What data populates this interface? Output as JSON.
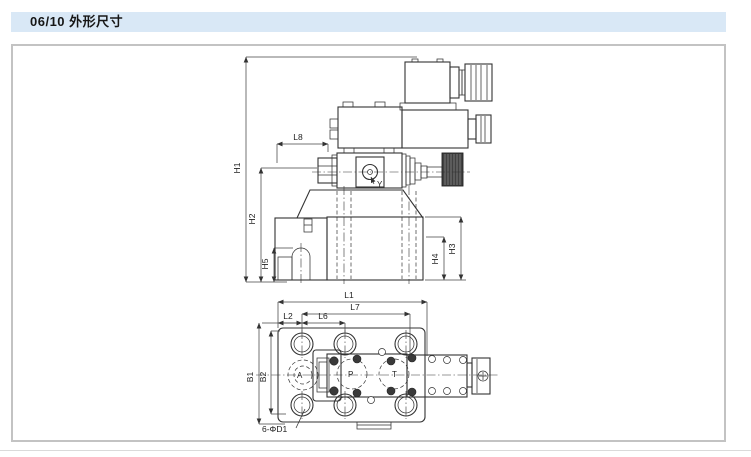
{
  "header": {
    "title": "06/10 外形尺寸"
  },
  "side_view": {
    "dims": {
      "h1": "H1",
      "h2": "H2",
      "h5": "H5",
      "l8": "L8",
      "h3": "H3",
      "h4": "H4"
    },
    "ports": {
      "y": "Y"
    }
  },
  "top_view": {
    "dims": {
      "l1": "L1",
      "l7": "L7",
      "l2": "L2",
      "l6": "L6",
      "b1": "B1",
      "b2": "B2"
    },
    "mount_holes_label": "6-ΦD1",
    "ports": {
      "a": "A",
      "p": "P",
      "t": "T"
    }
  },
  "colors": {
    "header_bg": "#d9e8f6",
    "line": "#333333",
    "panel_border": "#c3c3c3",
    "knob_fill": "#414141"
  }
}
